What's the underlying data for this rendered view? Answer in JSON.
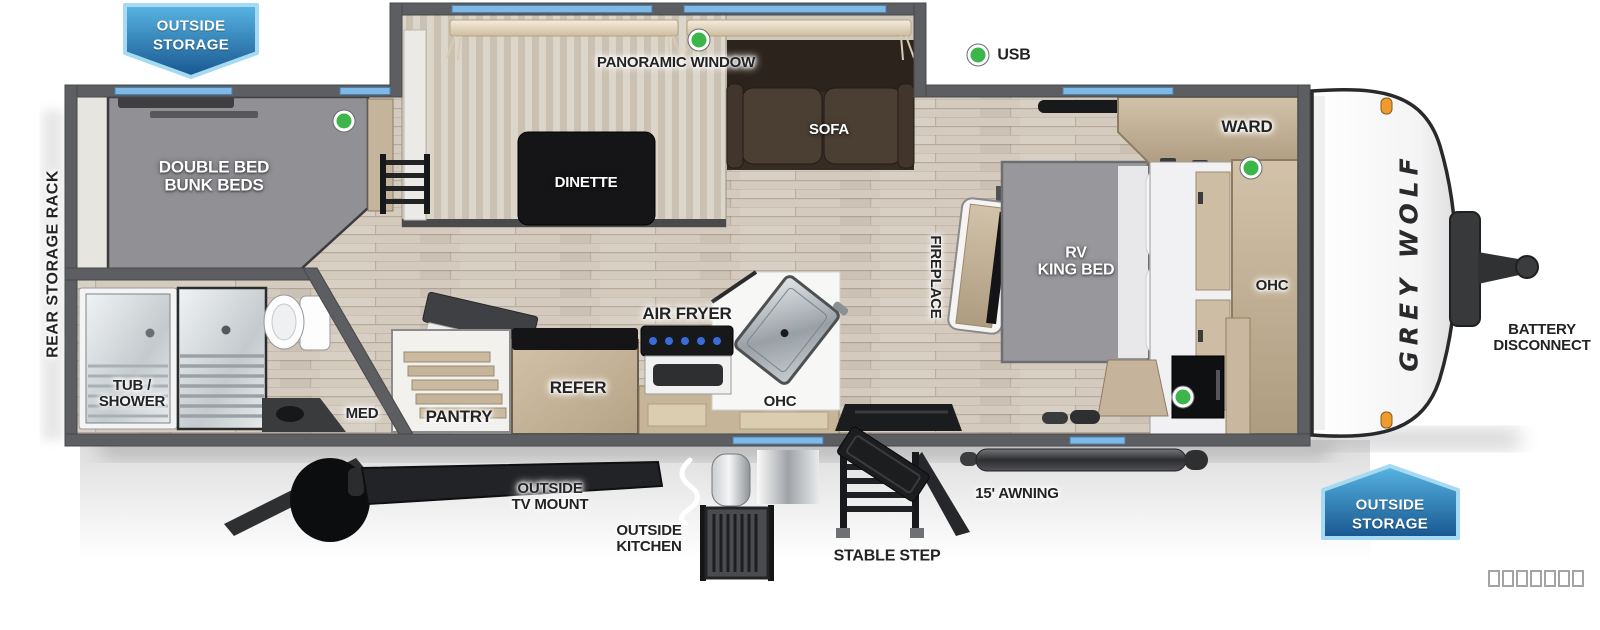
{
  "title": "Grey Wolf travel trailer floorplan",
  "brand": {
    "logo": "GREY WOLF"
  },
  "badges": {
    "top_left": {
      "line1": "OUTSIDE",
      "line2": "STORAGE"
    },
    "bottom_right": {
      "line1": "OUTSIDE",
      "line2": "STORAGE"
    }
  },
  "legend": {
    "usb": "USB",
    "placeholder_boxes": 7
  },
  "exterior": {
    "rear_storage_rack": "REAR STORAGE RACK",
    "battery": {
      "line1": "BATTERY",
      "line2": "DISCONNECT"
    },
    "tv_mount": {
      "line1": "OUTSIDE",
      "line2": "TV MOUNT"
    },
    "outside_kitchen": {
      "line1": "OUTSIDE",
      "line2": "KITCHEN"
    },
    "stable_step": "STABLE STEP",
    "awning": "15' AWNING"
  },
  "rooms": {
    "panoramic_window": "PANORAMIC WINDOW",
    "dinette": "DINETTE",
    "sofa": "SOFA",
    "bunks": {
      "line1": "DOUBLE BED",
      "line2": "BUNK BEDS"
    },
    "tub_shower": {
      "line1": "TUB /",
      "line2": "SHOWER"
    },
    "med": "MED",
    "pantry": "PANTRY",
    "refer": "REFER",
    "air_fryer": "AIR FRYER",
    "ohc_kitchen": "OHC",
    "fireplace": "FIREPLACE",
    "king_bed": {
      "line1": "RV",
      "line2": "KING BED"
    },
    "ward": "WARD",
    "ohc_bedroom": "OHC"
  },
  "colors": {
    "window_blue": "#7fb9e6",
    "badge_blue_top": "#55b3e1",
    "badge_blue_bottom": "#1a5c97",
    "usb_green": "#3cb54a",
    "marker_orange": "#ef9b30",
    "wall_gray": "#5d5e61",
    "floor_tan": "#d4cbbe"
  }
}
